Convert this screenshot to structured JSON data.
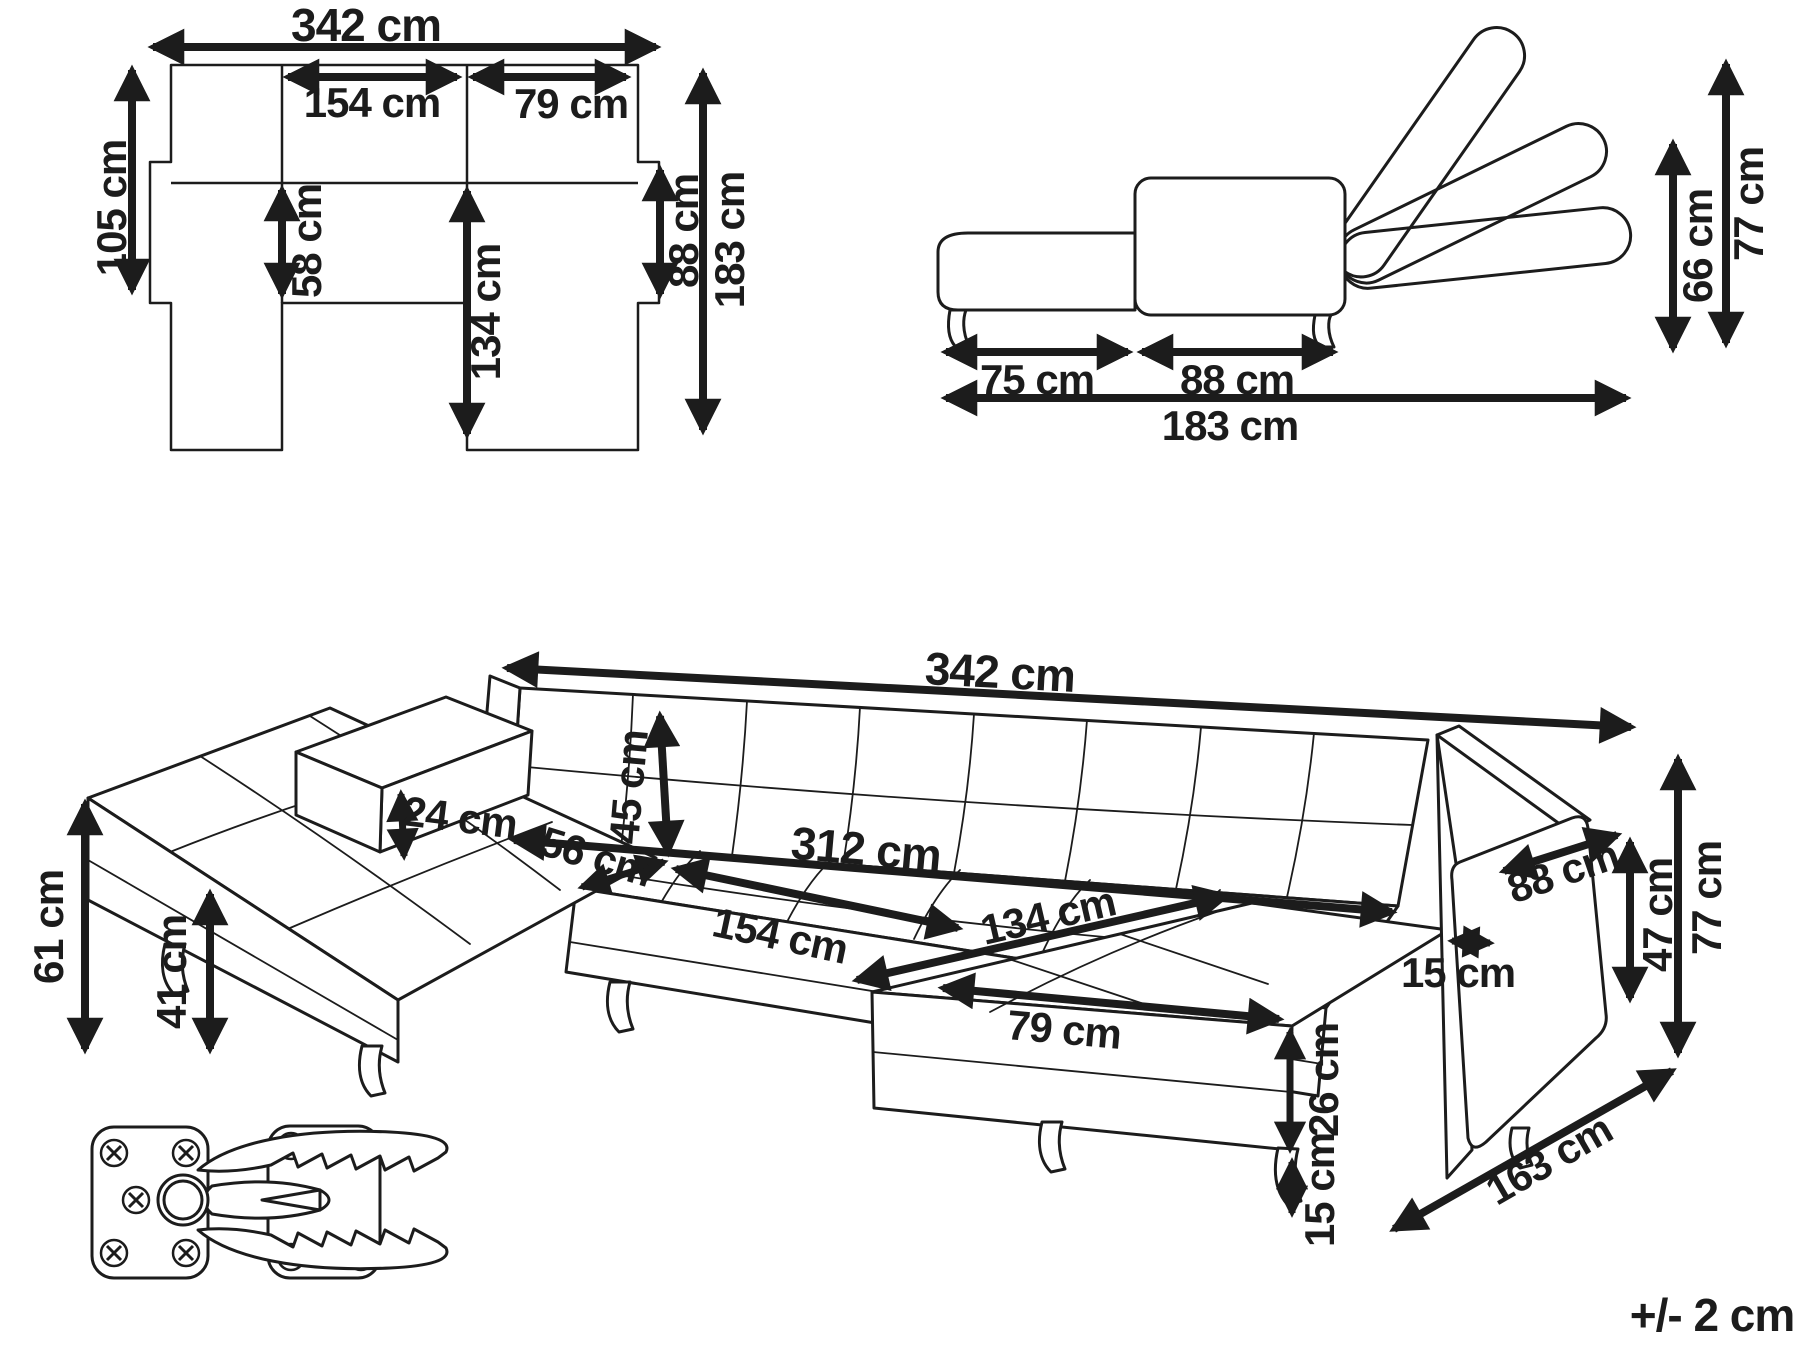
{
  "diagram": {
    "type": "furniture-dimension-diagram",
    "product": "u-shaped-sectional-sofa-bed",
    "tolerance_note": "+/- 2 cm",
    "views": {
      "top_view": {
        "dims": {
          "total_width": "342 cm",
          "bed_width": "154 cm",
          "right_section_width": "79 cm",
          "left_depth": "105 cm",
          "seat_depth": "58 cm",
          "chaise_length": "134 cm",
          "right_depth": "88 cm",
          "total_depth": "183 cm"
        }
      },
      "side_view": {
        "dims": {
          "chaise_length": "75 cm",
          "seat_length": "88 cm",
          "total_length": "183 cm",
          "seat_back_height": "66 cm",
          "max_height": "77 cm"
        }
      },
      "perspective_view": {
        "dims": {
          "total_width": "342 cm",
          "backrest_height": "45 cm",
          "armrest_above_seat": "24 cm",
          "seat_depth": "56 cm",
          "bed_width": "312 cm",
          "bed_length": "154 cm",
          "chaise_length": "134 cm",
          "chaise_width": "79 cm",
          "seat_front_height": "26 cm",
          "leg_height": "15 cm",
          "armrest_width": "15 cm",
          "armrest_depth": "88 cm",
          "armrest_side_height": "47 cm",
          "total_height": "77 cm",
          "total_depth": "163 cm",
          "seat_height": "61 cm",
          "base_height": "41 cm"
        }
      }
    }
  }
}
